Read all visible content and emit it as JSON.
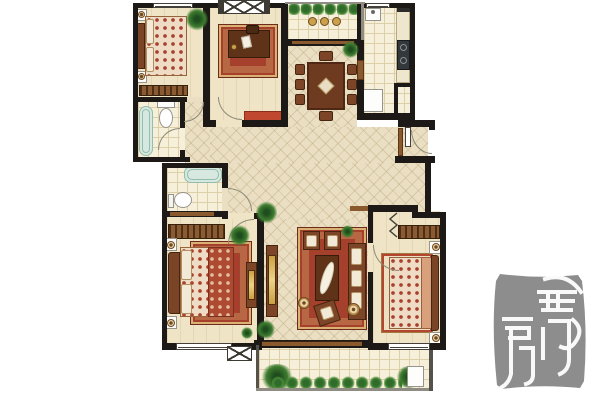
{
  "palette": {
    "background": "#ffffff",
    "wall": "#1c1916",
    "floor": "#efe5c6",
    "hall": "#eadfc2",
    "tile": "#f6efda",
    "rug": "#a5402c",
    "gold": "#d9b273",
    "wood": "#7c4628",
    "wooddark": "#552d14",
    "accent": "#c0482e",
    "tub": "#d6e8df",
    "plant": "#3f7d30",
    "seal": "#8d8d8d",
    "sealink": "#ffffff"
  },
  "seal": {
    "text": "融房",
    "style": "chinese-seal-stamp"
  },
  "rooms": [
    {
      "name": "bedroom-top-left"
    },
    {
      "name": "bathroom-top-left"
    },
    {
      "name": "study"
    },
    {
      "name": "balcony-top"
    },
    {
      "name": "dining-area"
    },
    {
      "name": "kitchen"
    },
    {
      "name": "entry-hall"
    },
    {
      "name": "bathroom-middle"
    },
    {
      "name": "master-bedroom"
    },
    {
      "name": "living-room"
    },
    {
      "name": "bedroom-bottom-right"
    },
    {
      "name": "balcony-bottom"
    }
  ]
}
